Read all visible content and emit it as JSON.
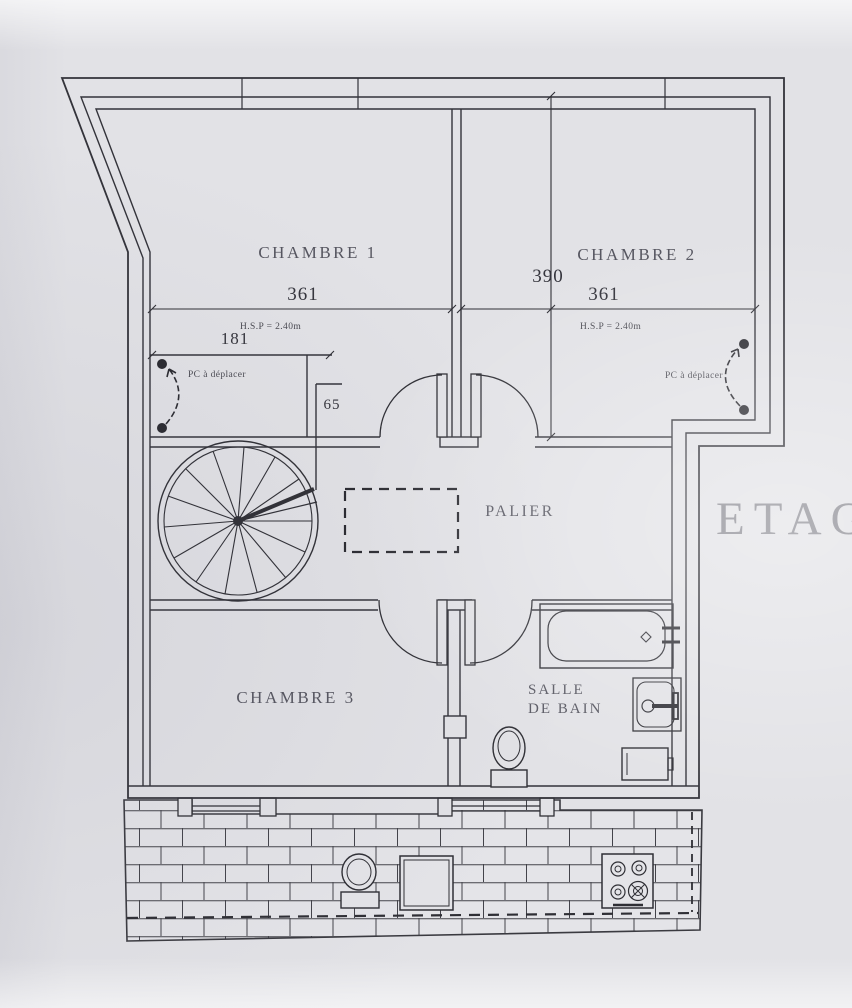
{
  "title": "ETAGE",
  "rooms": {
    "chambre1": "CHAMBRE 1",
    "chambre2": "CHAMBRE 2",
    "chambre3": "CHAMBRE 3",
    "palier": "PALIER",
    "sdb_line1": "SALLE",
    "sdb_line2": "DE BAIN"
  },
  "dims": {
    "chambre1_width": "361",
    "chambre2_width": "361",
    "chambre2_depth": "390",
    "closet_width": "181",
    "wall_stub": "65"
  },
  "notes": {
    "hsp_chambre1": "H.S.P = 2.40m",
    "hsp_chambre2": "H.S.P = 2.40m",
    "pc_chambre1": "PC à déplacer",
    "pc_chambre2": "PC à déplacer"
  },
  "fixtures": [
    "spiral-staircase",
    "bathtub",
    "washbasin",
    "toilet",
    "radiator",
    "stove",
    "table",
    "stair-trap-opening",
    "brick-terrace"
  ],
  "colors": {
    "paper": "#e2e2e6",
    "line": "#3a3a40",
    "label": "#565660",
    "title_text": "#86868e"
  }
}
